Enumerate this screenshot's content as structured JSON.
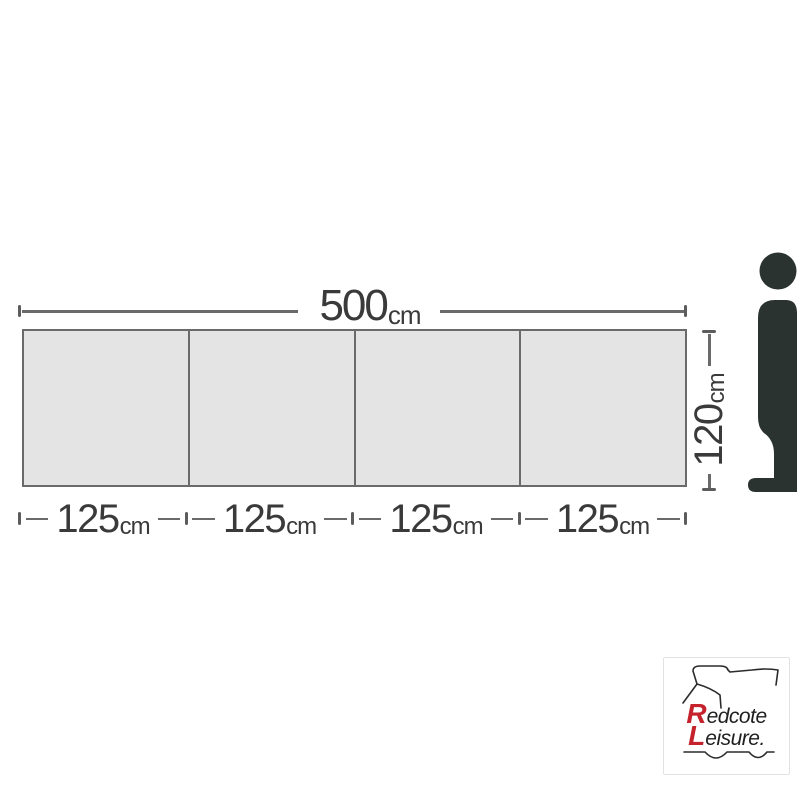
{
  "diagram": {
    "width_label": {
      "value": "500",
      "unit": "cm"
    },
    "height_label": {
      "value": "120",
      "unit": "cm"
    },
    "segment_labels": [
      {
        "value": "125",
        "unit": "cm"
      },
      {
        "value": "125",
        "unit": "cm"
      },
      {
        "value": "125",
        "unit": "cm"
      },
      {
        "value": "125",
        "unit": "cm"
      }
    ],
    "panel_count": 4,
    "colors": {
      "panel_fill": "#e4e4e4",
      "outline": "#6a6a6a",
      "dimension_line": "#6a6a6a",
      "label_text": "#3a3a3a",
      "figure_silhouette": "#2a3330"
    }
  },
  "figure": {
    "icon": "person-silhouette-icon"
  },
  "logo": {
    "line1_initial": "R",
    "line1_rest": "edcote",
    "line2_initial": "L",
    "line2_rest": "eisure.",
    "vehicle_icon": "motorhome-outline-icon",
    "accent_color": "#c5222b",
    "text_color": "#1f1f1f"
  }
}
